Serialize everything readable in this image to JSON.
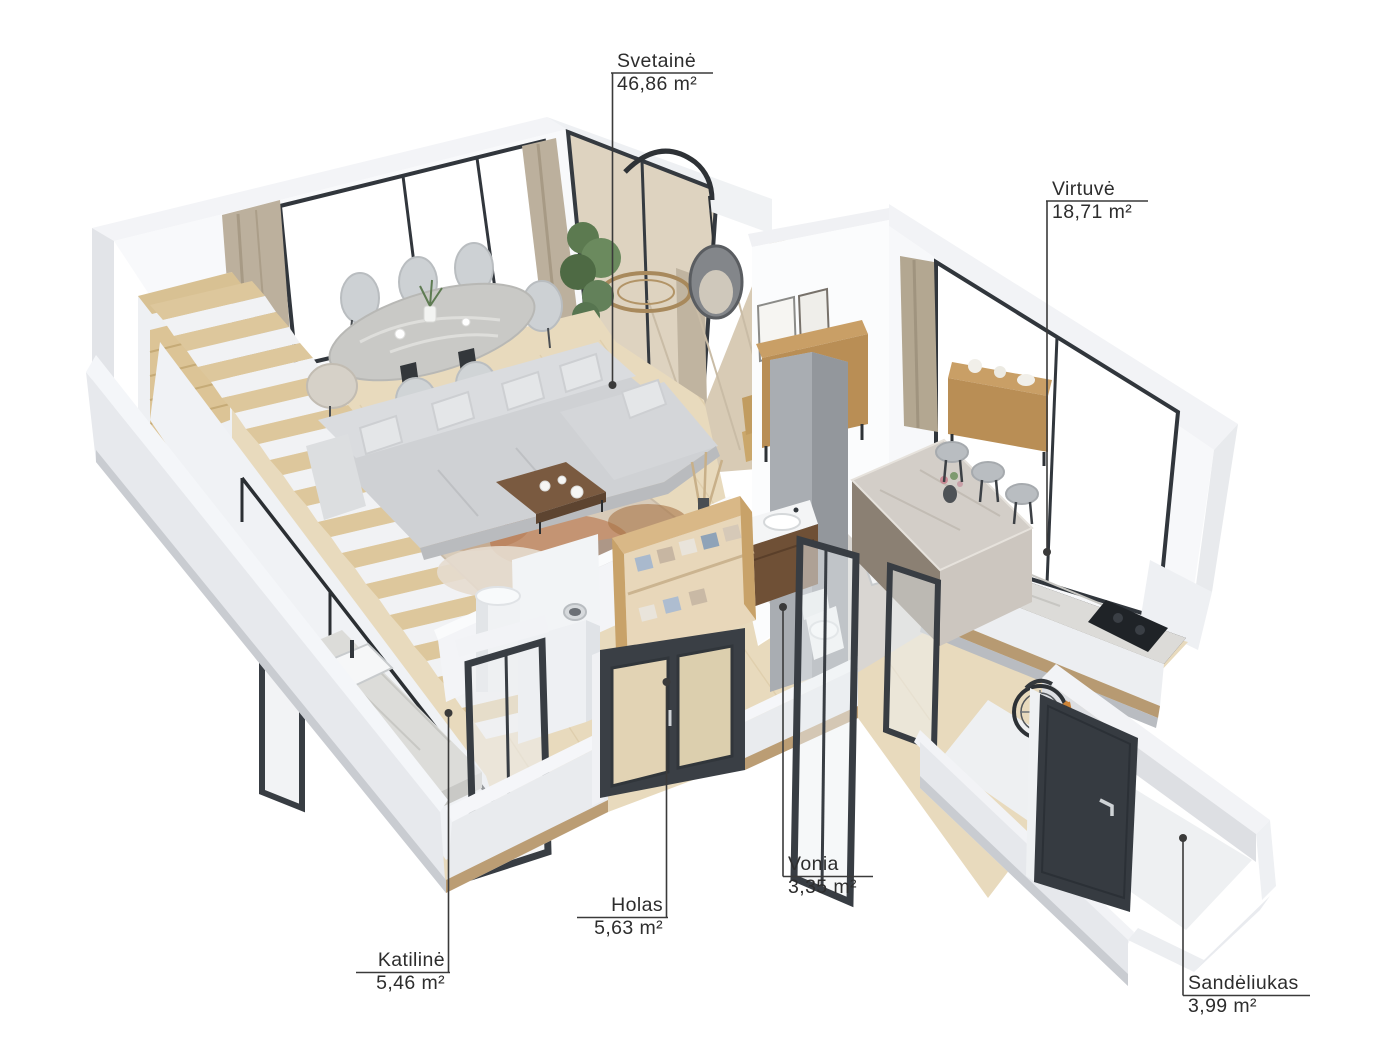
{
  "rooms": [
    {
      "id": "svetaine",
      "name": "Svetainė",
      "area": "46,86 m²"
    },
    {
      "id": "virtuve",
      "name": "Virtuvė",
      "area": "18,71 m²"
    },
    {
      "id": "vonia",
      "name": "Vonia",
      "area": "3,35 m²"
    },
    {
      "id": "holas",
      "name": "Holas",
      "area": "5,63 m²"
    },
    {
      "id": "katiline",
      "name": "Katilinė",
      "area": "5,46 m²"
    },
    {
      "id": "sandeliukas",
      "name": "Sandėliukas",
      "area": "3,99 m²"
    }
  ],
  "colors": {
    "label_text": "#2d2d2d",
    "leader_line": "#3a3a3a",
    "wall_white": "#f4f5f8",
    "wall_shade": "#e7e9ed",
    "floor_wood": "#e8dabd",
    "frame_dark": "#383d43",
    "wood_furniture": "#bd9159",
    "marble": "#dadad7",
    "sofa_gray": "#d2d4d7",
    "bike_orange": "#cd8438"
  }
}
